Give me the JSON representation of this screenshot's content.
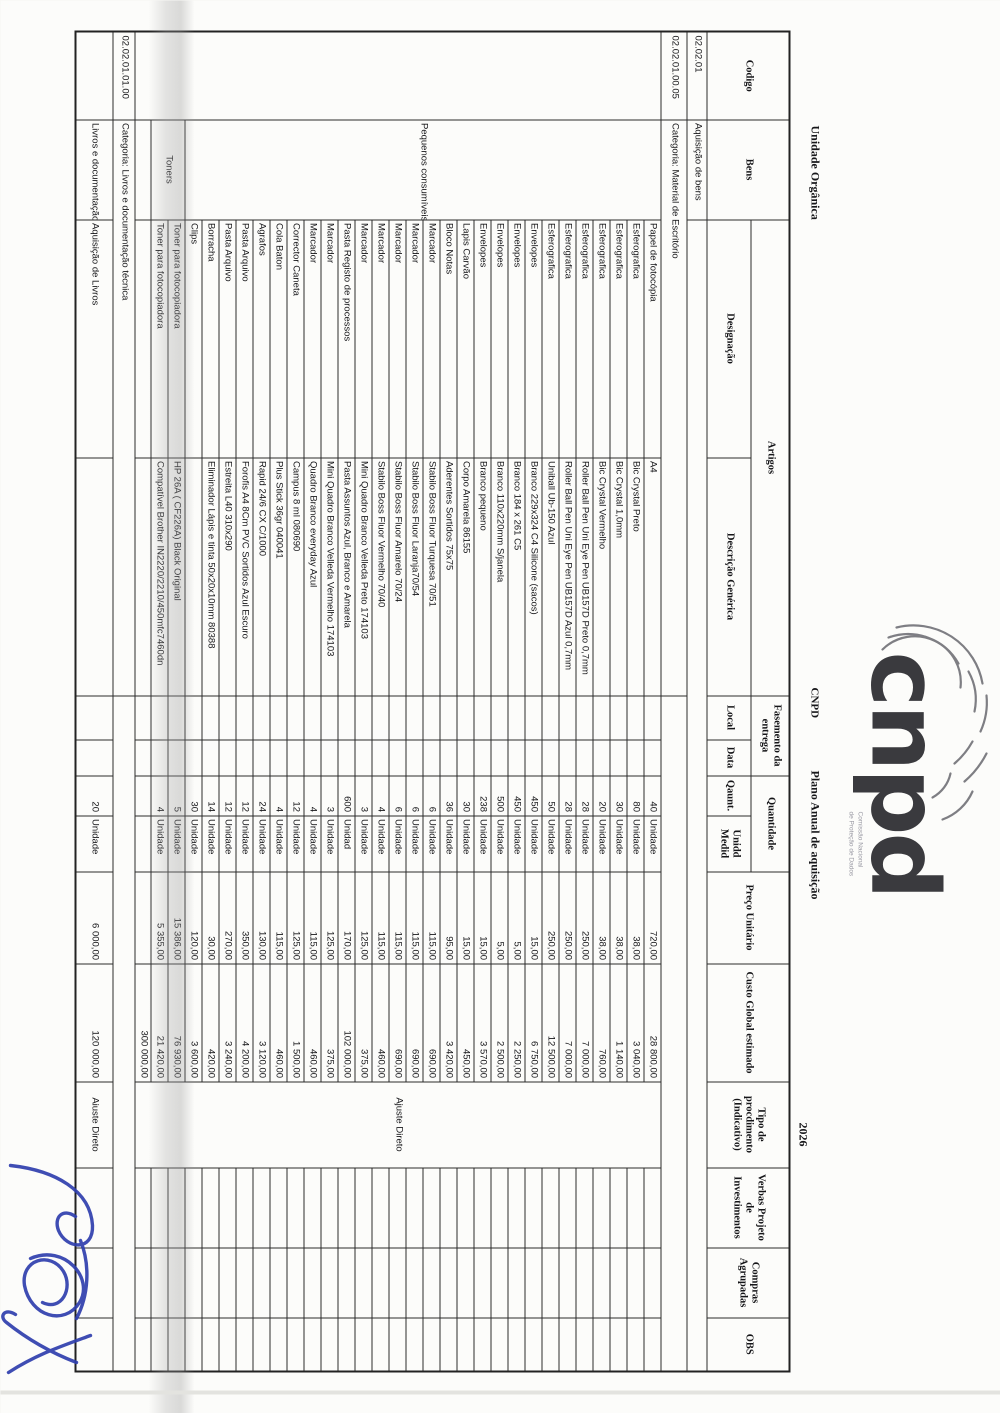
{
  "page": {
    "org_label": "Unidade Orgânica",
    "cnpd_abbrev": "CNPD",
    "doc_title": "Plano Anual de aquisição",
    "year": "2026",
    "logo_text": "cnpd",
    "logo_sub_line1": "Comissão Nacional",
    "logo_sub_line2": "de Proteção de Dados",
    "signature_color": "#2f3fae",
    "paper_color": "#fcfcfa"
  },
  "header": {
    "codigo": "Codigo",
    "bens": "Bens",
    "artigos": "Artigos",
    "designacao": "Designação",
    "descricao": "Descrição Genérica",
    "fasemento": "Fasemento da entrega",
    "local": "Local",
    "data": "Data",
    "quantidade": "Quantidade",
    "qaunt": "Qaunt.",
    "unidd": "Unidd Medid",
    "preco": "Preço Unitário",
    "custo": "Custo Global estimado",
    "tipo": "Tipo de procdimento (Indicativo)",
    "verbas": "Verbas Projeto de Investimentos",
    "compras": "Compras Agrupadas",
    "obs": "OBS"
  },
  "sections": {
    "material": {
      "codigo": "02.02.01",
      "bens_label": "Aquisição de bens",
      "categoria_codigo": "02.02.01.00.05",
      "categoria_label": "Categoria: Material de Escritório",
      "group_small": "Pequenos consumíveis",
      "group_toners": "Toners",
      "tipo_procedimento": "Ajuste Direto",
      "total_custo": "300 000,00",
      "items": [
        {
          "designacao": "Papel de fotocópia",
          "descricao": "A4",
          "qty": "40",
          "unit": "Unidade",
          "preco": "720,00",
          "custo": "28 800,00"
        },
        {
          "designacao": "Esferografica",
          "descricao": "Bic Crystal Preto",
          "qty": "80",
          "unit": "Unidade",
          "preco": "38,00",
          "custo": "3 040,00"
        },
        {
          "designacao": "Esferografica",
          "descricao": "Bic Crystal 1,0mm",
          "qty": "30",
          "unit": "Unidade",
          "preco": "38,00",
          "custo": "1 140,00"
        },
        {
          "designacao": "Esferografica",
          "descricao": "Bic Crystal Vermelho",
          "qty": "20",
          "unit": "Unidade",
          "preco": "38,00",
          "custo": "760,00"
        },
        {
          "designacao": "Esferografica",
          "descricao": "Roller Ball Pen Uni Eye Pen UB157D Preto 0,7mm",
          "qty": "28",
          "unit": "Unidade",
          "preco": "250,00",
          "custo": "7 000,00"
        },
        {
          "designacao": "Esferografica",
          "descricao": "Roller Ball Pen Uni Eye Pen UB157D Azul 0,7mm",
          "qty": "28",
          "unit": "Unidade",
          "preco": "250,00",
          "custo": "7 000,00"
        },
        {
          "designacao": "Esferografica",
          "descricao": "Uniball Ub-150 Azul",
          "qty": "50",
          "unit": "Unidade",
          "preco": "250,00",
          "custo": "12 500,00"
        },
        {
          "designacao": "Envelopes",
          "descricao": "Branco 229x324 C4 Silicone (sacos)",
          "qty": "450",
          "unit": "Unidade",
          "preco": "15,00",
          "custo": "6 750,00"
        },
        {
          "designacao": "Envelopes",
          "descricao": "Branco 184 x 261 C5",
          "qty": "450",
          "unit": "Unidade",
          "preco": "5,00",
          "custo": "2 250,00"
        },
        {
          "designacao": "Envelopes",
          "descricao": "Branco 110x220mm S/janela",
          "qty": "500",
          "unit": "Unidade",
          "preco": "5,00",
          "custo": "2 500,00"
        },
        {
          "designacao": "Envelopes",
          "descricao": "Branco pequeno",
          "qty": "238",
          "unit": "Unidade",
          "preco": "15,00",
          "custo": "3 570,00"
        },
        {
          "designacao": "Lapis Carvão",
          "descricao": "Corpo Amarela 86155",
          "qty": "30",
          "unit": "Unidade",
          "preco": "15,00",
          "custo": "450,00"
        },
        {
          "designacao": "Bloco Notas",
          "descricao": "Aderentes Sortidos 75x75",
          "qty": "36",
          "unit": "Unidade",
          "preco": "95,00",
          "custo": "3 420,00"
        },
        {
          "designacao": "Marcador",
          "descricao": "Stabilo Boss Fluor Turquesa 70/51",
          "qty": "6",
          "unit": "Unidade",
          "preco": "115,00",
          "custo": "690,00"
        },
        {
          "designacao": "Marcador",
          "descricao": "Stabilo Boss Fluor Laranja70/54",
          "qty": "6",
          "unit": "Unidade",
          "preco": "115,00",
          "custo": "690,00"
        },
        {
          "designacao": "Marcador",
          "descricao": "Stabilo Boss Fluor Amarelo 70/24",
          "qty": "6",
          "unit": "Unidade",
          "preco": "115,00",
          "custo": "690,00"
        },
        {
          "designacao": "Marcador",
          "descricao": "Stabilo Boss Fluor Vermelho 70/40",
          "qty": "4",
          "unit": "Unidade",
          "preco": "115,00",
          "custo": "460,00"
        },
        {
          "designacao": "Marcador",
          "descricao": "Mini Quadro Branco Velleda Preto 174103",
          "qty": "3",
          "unit": "Unidade",
          "preco": "125,00",
          "custo": "375,00"
        },
        {
          "designacao": "Pasta Registo de processos",
          "descricao": "Pasta Assuntos Azul, Branco e Amarela",
          "qty": "600",
          "unit": "Unidad",
          "preco": "170,00",
          "custo": "102 000,00"
        },
        {
          "designacao": "Marcador",
          "descricao": "Mini Quadro Branco Velleda Vermelho 174103",
          "qty": "3",
          "unit": "Unidade",
          "preco": "125,00",
          "custo": "375,00"
        },
        {
          "designacao": "Marcador",
          "descricao": "Quadro Branco everyday Azul",
          "qty": "4",
          "unit": "Unidade",
          "preco": "115,00",
          "custo": "460,00"
        },
        {
          "designacao": "Corrector Caneta",
          "descricao": "Campus 8 ml 080690",
          "qty": "12",
          "unit": "Unidade",
          "preco": "125,00",
          "custo": "1 500,00"
        },
        {
          "designacao": "Cola Baton",
          "descricao": "Plus Stick 36gr 040041",
          "qty": "4",
          "unit": "Unidade",
          "preco": "115,00",
          "custo": "460,00"
        },
        {
          "designacao": "Agrafos",
          "descricao": "Rapid 24/6 CX C/1000",
          "qty": "24",
          "unit": "Unidade",
          "preco": "130,00",
          "custo": "3 120,00"
        },
        {
          "designacao": "Pasta Arquivo",
          "descricao": "Forofis A4 8Cm PVC Sortidos Azul Escuro",
          "qty": "12",
          "unit": "Unidade",
          "preco": "350,00",
          "custo": "4 200,00"
        },
        {
          "designacao": "Pasta Arquivo",
          "descricao": "Estreita L40 310x290",
          "qty": "12",
          "unit": "Unidade",
          "preco": "270,00",
          "custo": "3 240,00"
        },
        {
          "designacao": "Borracha",
          "descricao": "Eliminador Lápis e tinta 50x20x10mm 80388",
          "qty": "14",
          "unit": "Unidade",
          "preco": "30,00",
          "custo": "420,00"
        },
        {
          "designacao": "Clips",
          "descricao": "",
          "qty": "30",
          "unit": "Unidade",
          "preco": "120,00",
          "custo": "3 600,00"
        },
        {
          "designacao": "Toner para fotocopiadora",
          "descricao": "HP 26A ( CF226A) Black Original",
          "qty": "5",
          "unit": "Unidade",
          "preco": "15 386,00",
          "custo": "76 930,00"
        },
        {
          "designacao": "Toner para fotocopiadora",
          "descricao": "Compatível Brother IN2220/2210/450mfc7460dn",
          "qty": "4",
          "unit": "Unidade",
          "preco": "5 355,00",
          "custo": "21 420,00"
        }
      ]
    },
    "livros": {
      "codigo": "02.02.01.01.00",
      "categoria_label": "Categoria: Livros e documentação técnica",
      "bens": "Livros e documentação",
      "designacao": "Aquisição de Livros",
      "qty": "20",
      "unit": "Unidade",
      "preco": "6 000,00",
      "custo": "120 000,00",
      "tipo_procedimento": "Aiuste Direto"
    }
  }
}
